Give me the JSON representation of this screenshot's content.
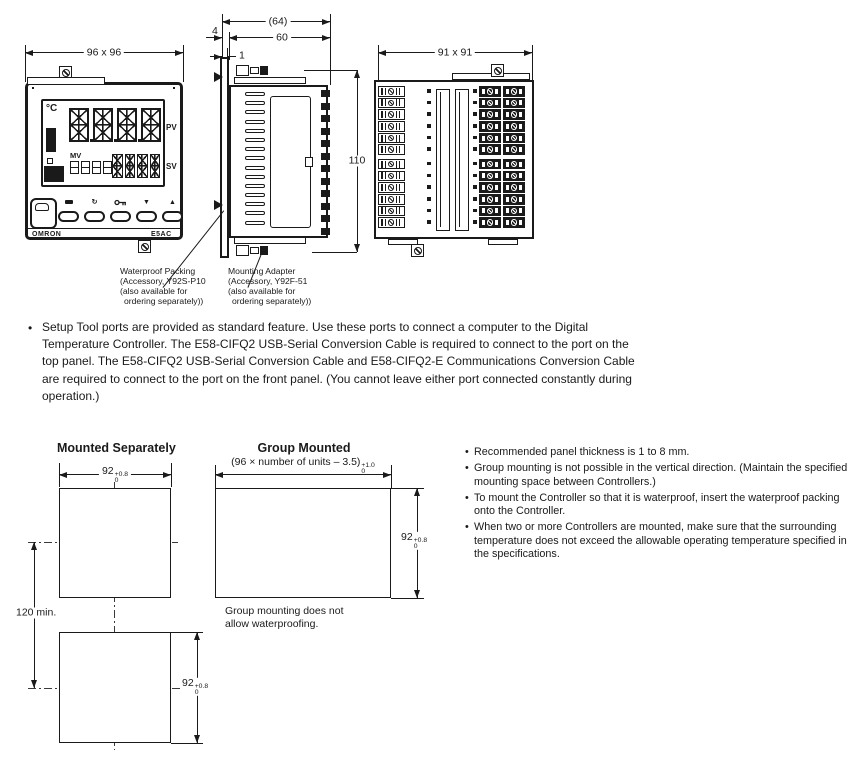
{
  "glyphs": {
    "bullet": "•"
  },
  "colors": {
    "ink": "#1a1a1a",
    "paper": "#ffffff"
  },
  "views": {
    "front": {
      "dim_width_height": "96 x 96",
      "display": {
        "unit": "°C",
        "pv_label": "PV",
        "sv_label": "SV",
        "mv_label": "MV"
      },
      "brand": "OMRON",
      "model": "E5AC",
      "buttons": [
        "level-key-icon",
        "mode-icon",
        "shift-key-icon",
        "down-icon",
        "up-icon"
      ]
    },
    "side": {
      "dim_total_depth": "(64)",
      "dim_body_depth": "60",
      "dim_bezel_depth": "4",
      "dim_panel_clearance": "1",
      "dim_height": "110"
    },
    "rear": {
      "dim_width_height": "91 x 91"
    }
  },
  "callouts": {
    "waterproof_packing": {
      "lines": [
        "Waterproof Packing",
        "(Accessory, Y92S-P10",
        "(also available for",
        "ordering separately))"
      ]
    },
    "mounting_adapter": {
      "lines": [
        "Mounting Adapter",
        "(Accessory, Y92F-51",
        "(also available for",
        "ordering separately))"
      ]
    }
  },
  "setup_note": {
    "text": "Setup Tool ports are provided as standard feature. Use these ports to connect a computer to the Digital Temperature Controller. The E58-CIFQ2 USB-Serial Conversion Cable is required to connect to the port on the top panel. The E58-CIFQ2 USB-Serial Conversion Cable and E58-CIFQ2-E Communications Conversion Cable are required to connect to the port on the front panel. (You cannot leave either port connected constantly during operation.)"
  },
  "panel_cutout": {
    "separate": {
      "title": "Mounted Separately",
      "width_value": "92",
      "width_tol_plus": "+0.8",
      "width_tol_minus": "0",
      "height_value": "92",
      "height_tol_plus": "+0.8",
      "height_tol_minus": "0",
      "pitch": "120 min."
    },
    "group": {
      "title": "Group Mounted",
      "formula": "(96 × number of units – 3.5)",
      "formula_tol_plus": "+1.0",
      "formula_tol_minus": "0",
      "height_value": "92",
      "height_tol_plus": "+0.8",
      "height_tol_minus": "0",
      "note_line1": "Group mounting does not",
      "note_line2": "allow waterproofing."
    },
    "notes": [
      "Recommended panel thickness is 1 to 8 mm.",
      "Group mounting is not possible in the vertical direction. (Maintain the specified mounting space between Controllers.)",
      "To mount the Controller so that it is waterproof, insert the waterproof packing onto the Controller.",
      "When two or more Controllers are mounted, make sure that the surrounding temperature does not exceed the allowable operating temperature specified in the specifications."
    ]
  }
}
